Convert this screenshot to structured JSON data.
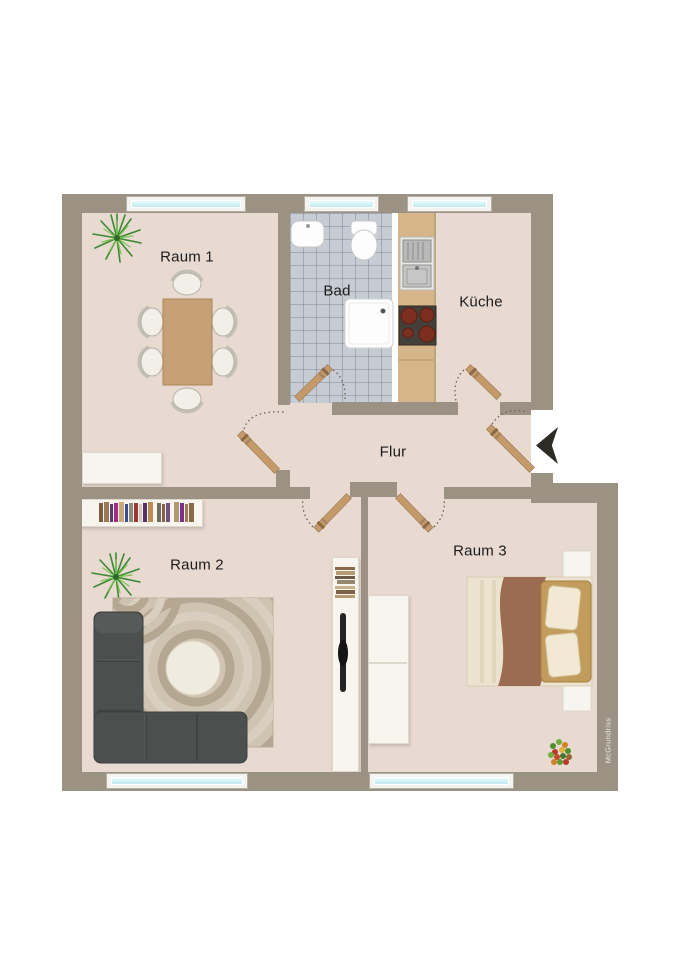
{
  "rooms": [
    {
      "id": "raum1",
      "label": "Raum 1"
    },
    {
      "id": "bad",
      "label": "Bad"
    },
    {
      "id": "kueche",
      "label": "Küche"
    },
    {
      "id": "flur",
      "label": "Flur"
    },
    {
      "id": "raum2",
      "label": "Raum 2"
    },
    {
      "id": "raum3",
      "label": "Raum 3"
    }
  ],
  "watermark": {
    "text": "McGrundriss"
  },
  "entrance": {
    "indicator": "entrance-arrow-icon",
    "direction": "left"
  },
  "colors": {
    "wall": "#9c9283",
    "floor": "#e8d9d1",
    "bath_tile": "#c7ccd4",
    "window_glass": "#cdeef4",
    "kitchen_counter": "#d6b588",
    "door_leaf": "#c49a6a",
    "sofa": "#4b4f4e",
    "rug": "#cfc3b2",
    "bed_blanket": "#9b6b52",
    "bed_headboard": "#c29c5c",
    "entrance_arrow": "#2e2b27",
    "label_text": "#1c1c1c"
  },
  "furniture": {
    "raum1": [
      "plant",
      "dining-table",
      "dining-chairs",
      "sideboard"
    ],
    "bad": [
      "washbasin",
      "toilet",
      "shower"
    ],
    "kueche": [
      "kitchen-counter",
      "kitchen-sink",
      "stove"
    ],
    "flur": [
      "interior-doors",
      "entrance-door"
    ],
    "raum2": [
      "bookshelf",
      "plant",
      "corner-sofa",
      "rug",
      "coffee-table",
      "media-shelf",
      "tv"
    ],
    "raum3": [
      "wardrobe",
      "double-bed",
      "nightstands",
      "flower-bouquet"
    ]
  }
}
